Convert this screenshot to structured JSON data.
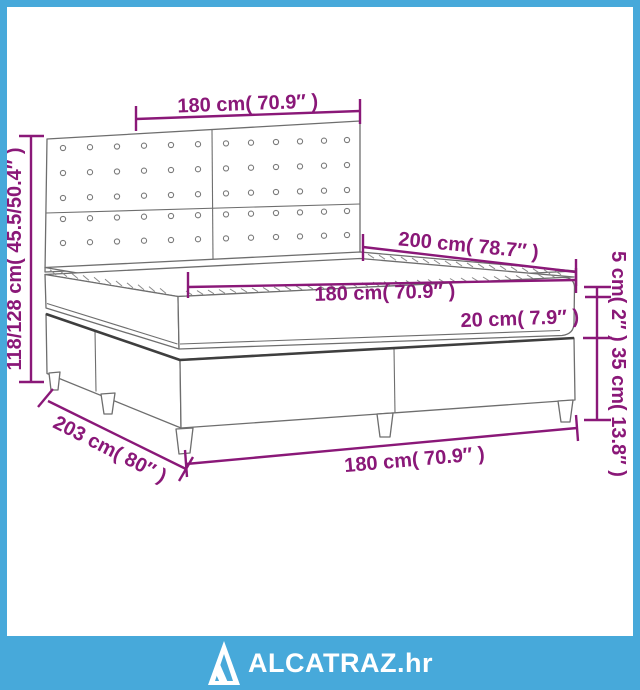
{
  "diagram": {
    "labels": {
      "headboard_width": "180 cm( 70.9″ )",
      "total_height": "118/128 cm( 45.5/50.4″ )",
      "mattress_length": "200 cm( 78.7″ )",
      "mattress_width": "180 cm( 70.9″ )",
      "mattress_thickness": "20 cm( 7.9″ )",
      "topper_base_heights": "5 cm( 2″ ) 35 cm( 13.8″ )",
      "frame_length": "203 cm( 80″ )",
      "frame_width": "180 cm( 70.9″ )"
    }
  },
  "branding": {
    "logo_text": "ALCATRAZ.hr"
  },
  "colors": {
    "dimension_magenta": "#8A1878",
    "brand_blue": "#47A9DA",
    "outline_gray": "#6E6E6E"
  }
}
